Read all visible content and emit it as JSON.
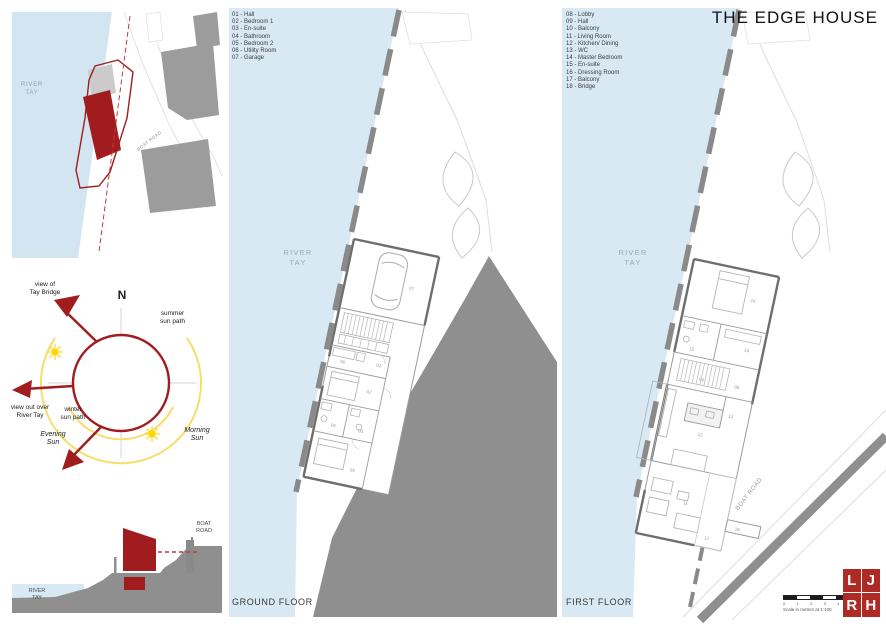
{
  "title": "THE EDGE HOUSE",
  "colors": {
    "water": "#D8E9F4",
    "accent_red": "#A01C1F",
    "dashed_red": "#C43B3C",
    "sun_yellow": "#F7DE6B",
    "sun_symbol": "#FFD500",
    "terrain_gray": "#8F8F8F",
    "building_gray": "#9C9C9C"
  },
  "site_plan": {
    "river_label": [
      "RIVER",
      "TAY"
    ],
    "road_label": "BOAT ROAD"
  },
  "sun_diagram": {
    "north": "N",
    "view_tay_bridge": [
      "view of",
      "Tay Bridge"
    ],
    "summer_path": [
      "summer",
      "sun path"
    ],
    "winter_path": [
      "winter",
      "sun path"
    ],
    "view_river": [
      "view out over",
      "River Tay"
    ],
    "evening_sun": [
      "Evening",
      "Sun"
    ],
    "morning_sun": [
      "Morning",
      "Sun"
    ]
  },
  "section": {
    "road_label": [
      "BOAT",
      "ROAD"
    ],
    "river_label": [
      "RIVER",
      "TAY"
    ]
  },
  "ground_floor": {
    "label": "GROUND FLOOR",
    "river_label": [
      "RIVER",
      "TAY"
    ],
    "legend": [
      "01 - Hall",
      "02 - Bedroom 1",
      "03 - En-suite",
      "04 - Bathroom",
      "05 - Bedroom 2",
      "06 - Utility Room",
      "07 - Garage"
    ],
    "room_numbers": [
      "01",
      "02",
      "03",
      "04",
      "05",
      "06",
      "07"
    ]
  },
  "first_floor": {
    "label": "FIRST FLOOR",
    "river_label": [
      "RIVER",
      "TAY"
    ],
    "road_label": "BOAT ROAD",
    "legend": [
      "08 - Lobby",
      "09 - Hall",
      "10 - Balcony",
      "11 - Living Room",
      "12 - Kitchen/ Dining",
      "13 - WC",
      "14 - Master Bedroom",
      "15 - En-suite",
      "16 - Dressing Room",
      "17 - Balcony",
      "18 - Bridge"
    ],
    "room_numbers": [
      "08",
      "09",
      "10",
      "11",
      "12",
      "13",
      "14",
      "15",
      "16",
      "17",
      "18"
    ]
  },
  "footer": {
    "scale_numbers": [
      "0",
      "1",
      "2",
      "3",
      "4",
      "5"
    ],
    "scale_caption": "Scale in metres at 1:100",
    "logo": {
      "tl": "L",
      "tr": "J",
      "bl": "R",
      "br": "H"
    }
  }
}
